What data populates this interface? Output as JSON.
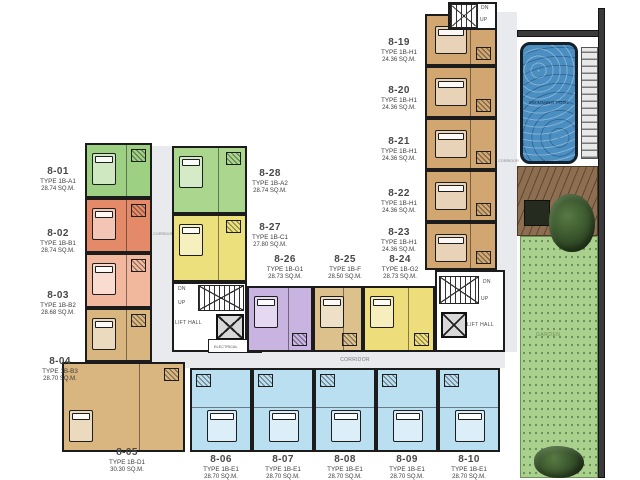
{
  "labels": {
    "corridor": "CORRIDOR",
    "lift_hall": "LIFT HALL",
    "electrical": "ELECTRICAL",
    "down": "DN",
    "up": "UP",
    "garden": "GARDEN",
    "pool": "SWIMMING POOL"
  },
  "palette": {
    "wall": "#1c1c1c",
    "corridor_fill": "#e8eaed",
    "pool_water": "#4b8fc2",
    "deck_wood": "#8d6e50",
    "garden_green": "#a9d08d",
    "tree_green": "#37522c"
  },
  "units": {
    "west_outer": [
      {
        "id": "8-01",
        "type": "TYPE 1B-A1",
        "area": "28.74 SQ.M.",
        "color": "#9ed084"
      },
      {
        "id": "8-02",
        "type": "TYPE 1B-B1",
        "area": "28.74 SQ.M.",
        "color": "#e58a69"
      },
      {
        "id": "8-03",
        "type": "TYPE 1B-B2",
        "area": "28.68 SQ.M.",
        "color": "#f2b89e"
      },
      {
        "id": "8-04",
        "type": "TYPE 1B-B3",
        "area": "28.70 SQ.M.",
        "color": "#d9b57f"
      },
      {
        "id": "8-05",
        "type": "TYPE 1B-D1",
        "area": "30.30 SQ.M.",
        "color": "#d9b57f"
      }
    ],
    "west_inner": [
      {
        "id": "8-28",
        "type": "TYPE 1B-A2",
        "area": "28.74 SQ.M.",
        "color": "#aad68e"
      },
      {
        "id": "8-27",
        "type": "TYPE 1B-C1",
        "area": "27.80 SQ.M.",
        "color": "#ebe07b"
      }
    ],
    "center": [
      {
        "id": "8-26",
        "type": "TYPE 1B-G1",
        "area": "28.73 SQ.M.",
        "color": "#c8b3e1"
      },
      {
        "id": "8-25",
        "type": "TYPE 1B-F",
        "area": "28.50 SQ.M.",
        "color": "#dcc18c"
      },
      {
        "id": "8-24",
        "type": "TYPE 1B-G2",
        "area": "28.73 SQ.M.",
        "color": "#eedd7b"
      }
    ],
    "east": [
      {
        "id": "8-19",
        "type": "TYPE 1B-H1",
        "area": "24.36 SQ.M.",
        "color": "#d1a671"
      },
      {
        "id": "8-20",
        "type": "TYPE 1B-H1",
        "area": "24.36 SQ.M.",
        "color": "#d1a671"
      },
      {
        "id": "8-21",
        "type": "TYPE 1B-H1",
        "area": "24.36 SQ.M.",
        "color": "#d1a671"
      },
      {
        "id": "8-22",
        "type": "TYPE 1B-H1",
        "area": "24.36 SQ.M.",
        "color": "#d1a671"
      },
      {
        "id": "8-23",
        "type": "TYPE 1B-H1",
        "area": "24.36 SQ.M.",
        "color": "#d1a671"
      }
    ],
    "south": [
      {
        "id": "8-06",
        "type": "TYPE 1B-E1",
        "area": "28.70 SQ.M.",
        "color": "#b9dff1"
      },
      {
        "id": "8-07",
        "type": "TYPE 1B-E1",
        "area": "28.70 SQ.M.",
        "color": "#b9dff1"
      },
      {
        "id": "8-08",
        "type": "TYPE 1B-E1",
        "area": "28.70 SQ.M.",
        "color": "#b9dff1"
      },
      {
        "id": "8-09",
        "type": "TYPE 1B-E1",
        "area": "28.70 SQ.M.",
        "color": "#b9dff1"
      },
      {
        "id": "8-10",
        "type": "TYPE 1B-E1",
        "area": "28.70 SQ.M.",
        "color": "#b9dff1"
      }
    ]
  }
}
